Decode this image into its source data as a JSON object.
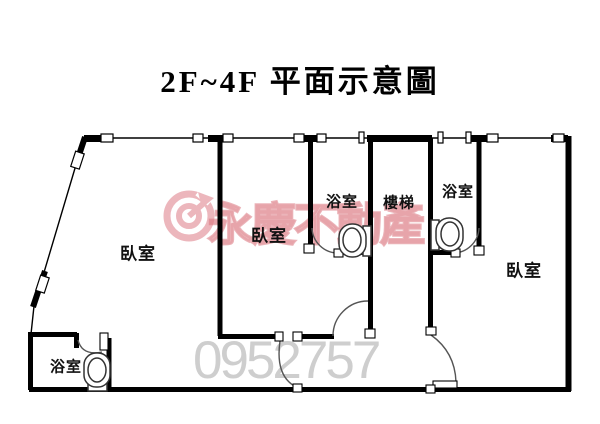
{
  "title": "2F~4F 平面示意圖",
  "rooms": [
    {
      "id": "bedroom-left",
      "label": "臥室"
    },
    {
      "id": "bedroom-middle",
      "label": "臥室"
    },
    {
      "id": "bedroom-right",
      "label": "臥室"
    },
    {
      "id": "bathroom-bottom-left",
      "label": "浴室"
    },
    {
      "id": "bathroom-middle",
      "label": "浴室"
    },
    {
      "id": "bathroom-right",
      "label": "浴室"
    },
    {
      "id": "stairs",
      "label": "樓梯"
    }
  ],
  "watermark": {
    "brand": "永慶不動產",
    "number": "0952757"
  },
  "colors": {
    "wall": "#000000",
    "door_arc": "#555555",
    "watermark_pink": "#dd7b86",
    "watermark_gray": "#c9c9c9",
    "background": "#ffffff"
  }
}
